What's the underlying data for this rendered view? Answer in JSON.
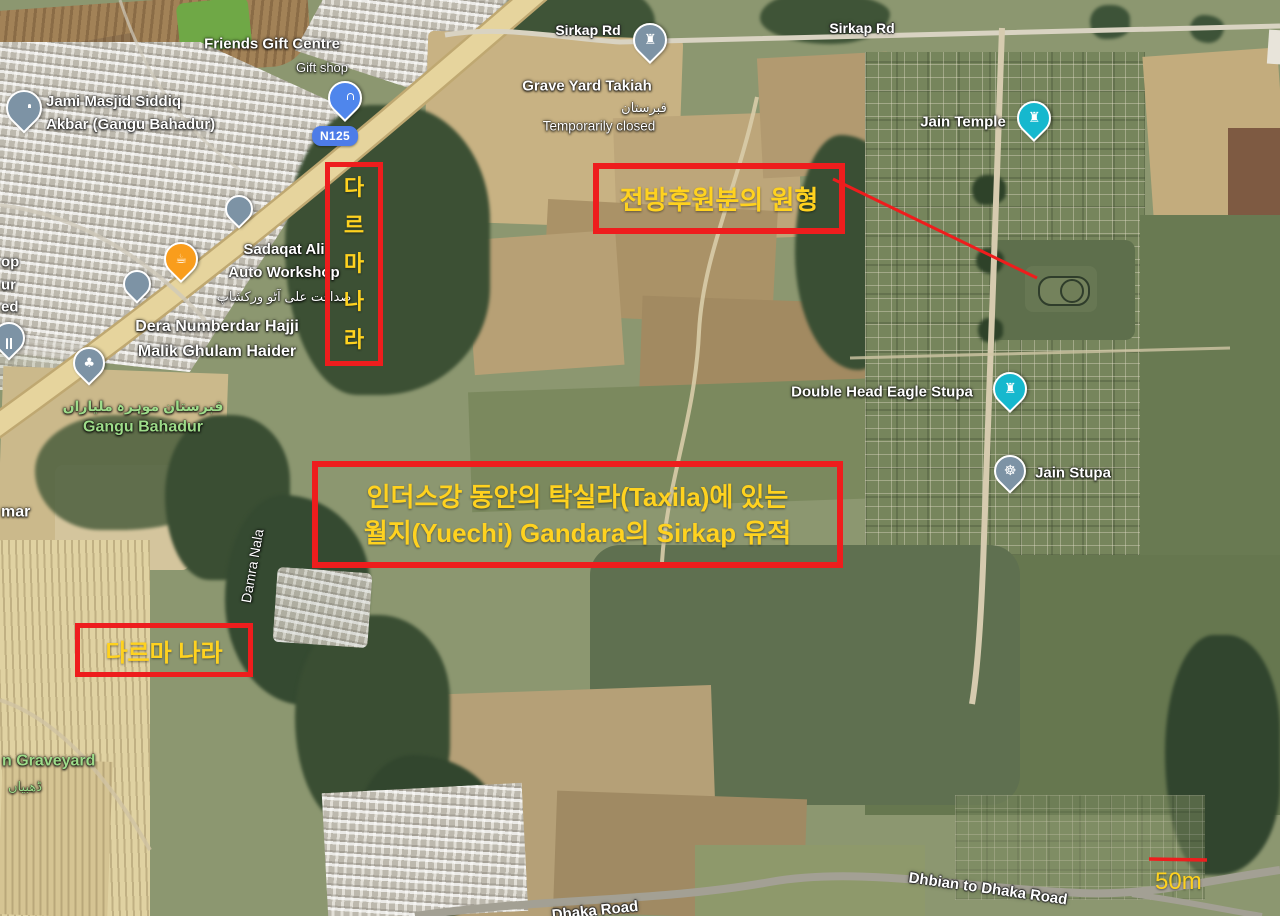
{
  "colors": {
    "annotation_red": "#ee1d1d",
    "annotation_yellow": "#ffd21f",
    "label_white": "#ffffff",
    "label_green": "#9edc8a",
    "route_badge_blue": "#4d7ce8",
    "pin_teal": "#16b8ce",
    "pin_gray": "#7d93a5",
    "pin_blue": "#4f86ec",
    "pin_orange": "#f99d1c"
  },
  "icons": {
    "rook": "♜",
    "coffee": "☕",
    "dharma_wheel": "☸",
    "trees": "♣"
  },
  "map_labels": {
    "friends_gift_centre": "Friends Gift Centre",
    "friends_gift_centre_sub": "Gift shop",
    "jami_masjid": "Jami Masjid Siddiq\nAkbar (Gangu Bahadur)",
    "route_badge": "N125",
    "sirkap_rd_left": "Sirkap Rd",
    "sirkap_rd_right": "Sirkap Rd",
    "grave_yard_title": "Grave Yard Takiah",
    "grave_yard_urdu": "قبرستان",
    "grave_yard_status": "Temporarily closed",
    "sadaqat_name": "Sadaqat Ali\nAuto Workshop",
    "sadaqat_urdu": "صداقت علی آٹو ورکشاپ",
    "dera": "Dera Numberdar Hajji\nMalik Ghulam Haider",
    "gangu_urdu": "قبرستان موہرہ ملیاراں",
    "gangu_name": "Gangu Bahadur",
    "jain_temple": "Jain Temple",
    "double_head_eagle_stupa": "Double Head Eagle Stupa",
    "jain_stupa": "Jain Stupa",
    "damra_nala": "Damra Nala",
    "graveyard_partial": "n Graveyard",
    "graveyard_urdu_partial": "ڈھبیاں",
    "dhbian_to_dhaka_road": "Dhbian to Dhaka Road",
    "dhaka_road": "Dhaka Road",
    "edge_partial_op": "op",
    "edge_partial_ur": "ur",
    "edge_partial_ed": "ed",
    "edge_partial_mar": "mar"
  },
  "annotations": {
    "vertical_box_text": "다\n르\n마\n나\n라",
    "keyhole_box_text": "전방후원분의 원형",
    "main_box_text": "인더스강 동안의 탁실라(Taxila)에 있는\n월지(Yuechi) Gandara의 Sirkap 유적",
    "dharma_box_text": "다르마 나라"
  },
  "scale_bar": {
    "label": "50m"
  }
}
